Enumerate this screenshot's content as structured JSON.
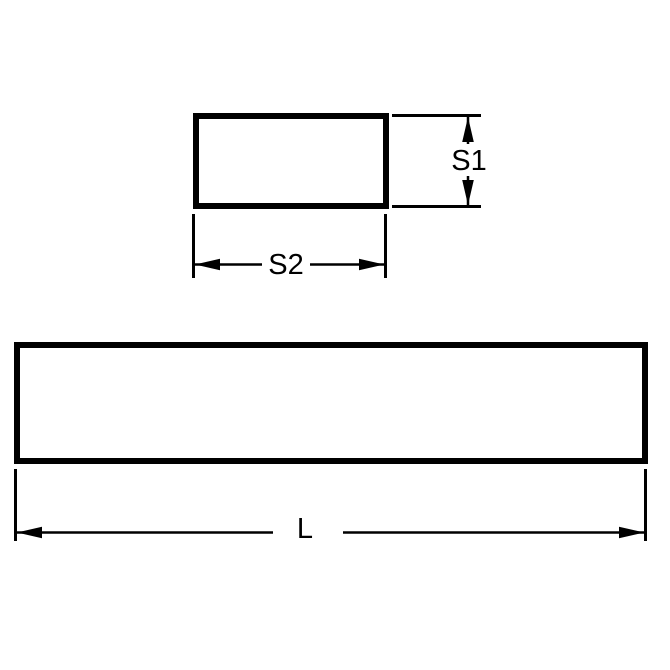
{
  "colors": {
    "ink": "#000000",
    "paper": "#ffffff"
  },
  "dimensions": {
    "s1_label": "S1",
    "s2_label": "S2",
    "l_label": "L"
  }
}
